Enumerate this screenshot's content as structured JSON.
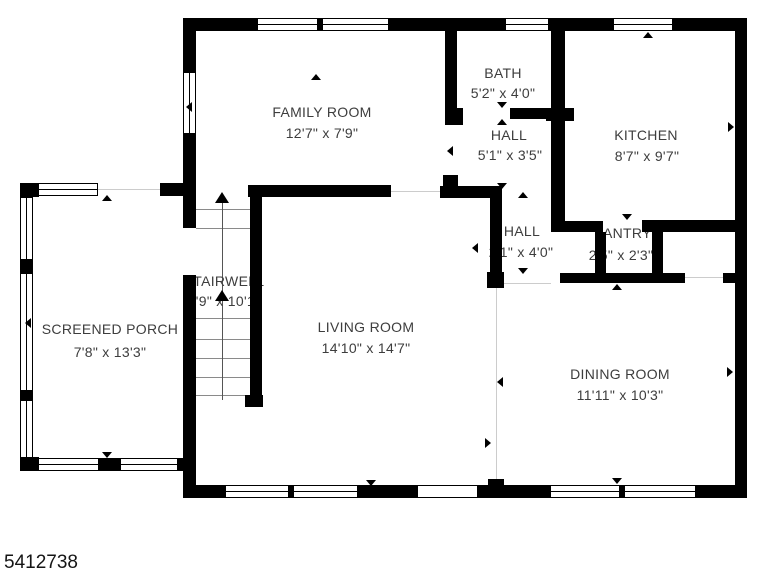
{
  "floorplan": {
    "rooms": [
      {
        "name": "FAMILY ROOM",
        "dims": "12'7\" x 7'9\""
      },
      {
        "name": "BATH",
        "dims": "5'2\" x 4'0\""
      },
      {
        "name": "HALL",
        "dims": "5'1\" x 3'5\""
      },
      {
        "name": "KITCHEN",
        "dims": "8'7\" x 9'7\""
      },
      {
        "name": "HALL",
        "dims": "2'1\" x 4'0\""
      },
      {
        "name": "PANTRY",
        "dims": "2'5\" x 2'3\""
      },
      {
        "name": "STAIRWELL",
        "dims": "3'9\" x 10'1\""
      },
      {
        "name": "SCREENED PORCH",
        "dims": "7'8\" x 13'3\""
      },
      {
        "name": "LIVING ROOM",
        "dims": "14'10\" x 14'7\""
      },
      {
        "name": "DINING ROOM",
        "dims": "11'11\" x 10'3\""
      }
    ],
    "watermark": "5412738",
    "colors": {
      "wall": "#000000",
      "background": "#ffffff",
      "label": "#3d3d3d"
    }
  }
}
